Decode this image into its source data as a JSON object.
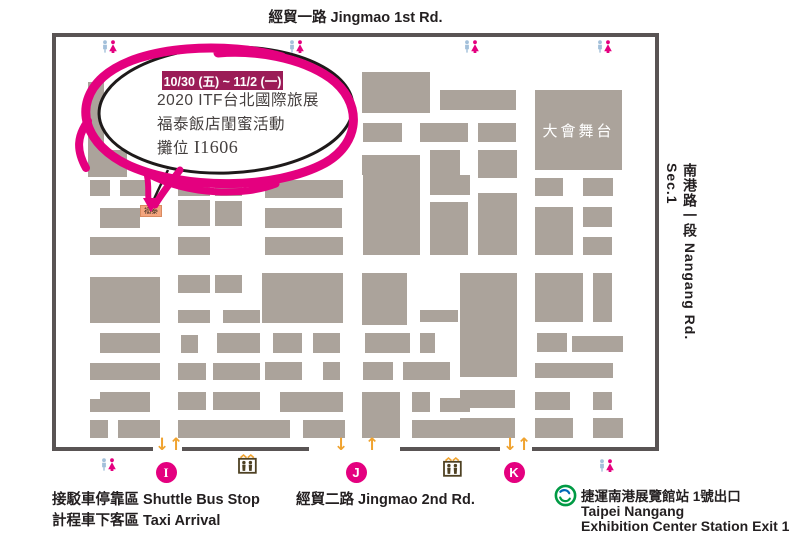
{
  "roads": {
    "top": "經貿一路 Jingmao 1st Rd.",
    "right": "南港路一段  Nangang Rd. Sec.1",
    "bottom": "經貿二路 Jingmao 2nd Rd."
  },
  "bubble": {
    "badge": "10/30 (五) ~ 11/2 (一)",
    "line1": "2020 ITF台北國際旅展",
    "line2": "福泰飯店閨蜜活動",
    "booth_prefix": "攤位 ",
    "booth_no": "I1606"
  },
  "marker": {
    "label": "福泰"
  },
  "stage": {
    "label": "大會舞台"
  },
  "legend": {
    "shuttle": "接駁車停靠區 Shuttle Bus Stop",
    "taxi": "計程車下客區 Taxi Arrival",
    "metro_station_cjk": "捷運南港展覽館站 1號出口",
    "metro_en1": "Taipei Nangang",
    "metro_en2": "Exhibition Center Station Exit 1"
  },
  "icons": {
    "down_arrow": "↓",
    "up_arrow": "↑",
    "restroom": "restroom-icon (male blue / female pink)",
    "escalator": "escalator-icon",
    "metro": "taipei-metro-logo"
  },
  "colors": {
    "booth_gray": "#ABA39B",
    "map_border": "#595454",
    "highlight_pink": "#E4007F",
    "badge_maroon": "#9B1C57",
    "arrow_orange": "#F0A32F",
    "marker_orange": "#F4A57E",
    "escalator_brown": "#4E4123",
    "restroom_male_blue": "#A3C0DA",
    "metro_green": "#009A44",
    "metro_blue": "#0068B7"
  },
  "entrances": [
    {
      "label": "I",
      "cx": 166,
      "down_x": 155,
      "up_x": 169,
      "serif": true
    },
    {
      "label": "J",
      "cx": 356,
      "down_x": 334,
      "up_x": 365,
      "serif": false
    },
    {
      "label": "K",
      "cx": 514,
      "down_x": 503,
      "up_x": 517,
      "serif": false
    }
  ],
  "map": {
    "frame": {
      "x": 52,
      "y": 33,
      "w": 607,
      "h": 418,
      "thickness": 4
    },
    "border_bottom_y": 447,
    "border_bottom_segments": [
      [
        52,
        101
      ],
      [
        182,
        127
      ],
      [
        400,
        100
      ],
      [
        532,
        127
      ]
    ],
    "restrooms": [
      [
        101,
        40
      ],
      [
        288,
        40
      ],
      [
        463,
        40
      ],
      [
        596,
        40
      ],
      [
        100,
        458
      ],
      [
        598,
        459
      ]
    ],
    "escalators": [
      [
        238,
        453
      ],
      [
        443,
        456
      ]
    ],
    "blocks": [
      [
        88,
        82,
        16,
        71
      ],
      [
        88,
        150,
        39,
        27
      ],
      [
        90,
        180,
        20,
        16
      ],
      [
        120,
        180,
        30,
        16
      ],
      [
        178,
        180,
        32,
        16
      ],
      [
        215,
        180,
        27,
        16
      ],
      [
        100,
        208,
        40,
        20
      ],
      [
        178,
        200,
        32,
        26
      ],
      [
        215,
        201,
        27,
        25
      ],
      [
        90,
        237,
        70,
        18
      ],
      [
        178,
        237,
        32,
        18
      ],
      [
        265,
        237,
        78,
        18
      ],
      [
        90,
        277,
        70,
        46
      ],
      [
        178,
        275,
        32,
        18
      ],
      [
        215,
        275,
        27,
        18
      ],
      [
        178,
        310,
        32,
        13
      ],
      [
        223,
        310,
        37,
        13
      ],
      [
        265,
        180,
        78,
        18
      ],
      [
        265,
        208,
        77,
        20
      ],
      [
        262,
        273,
        81,
        50
      ],
      [
        100,
        333,
        60,
        20
      ],
      [
        181,
        335,
        17,
        18
      ],
      [
        217,
        333,
        43,
        20
      ],
      [
        273,
        333,
        29,
        20
      ],
      [
        313,
        333,
        27,
        20
      ],
      [
        90,
        363,
        70,
        17
      ],
      [
        178,
        363,
        28,
        17
      ],
      [
        213,
        363,
        47,
        17
      ],
      [
        265,
        362,
        37,
        18
      ],
      [
        323,
        362,
        17,
        18
      ],
      [
        100,
        392,
        50,
        7
      ],
      [
        90,
        399,
        60,
        13
      ],
      [
        178,
        392,
        28,
        18
      ],
      [
        213,
        392,
        47,
        18
      ],
      [
        280,
        392,
        63,
        20
      ],
      [
        90,
        420,
        18,
        18
      ],
      [
        118,
        420,
        42,
        18
      ],
      [
        178,
        420,
        82,
        18
      ],
      [
        260,
        420,
        30,
        18
      ],
      [
        303,
        420,
        42,
        18
      ],
      [
        363,
        170,
        57,
        85
      ],
      [
        362,
        273,
        45,
        52
      ],
      [
        365,
        333,
        45,
        20
      ],
      [
        420,
        333,
        15,
        20
      ],
      [
        363,
        362,
        30,
        18
      ],
      [
        403,
        362,
        47,
        18
      ],
      [
        362,
        392,
        38,
        46
      ],
      [
        412,
        392,
        18,
        20
      ],
      [
        440,
        398,
        30,
        14
      ],
      [
        412,
        420,
        58,
        18
      ],
      [
        362,
        72,
        68,
        41
      ],
      [
        440,
        90,
        76,
        20
      ],
      [
        363,
        123,
        39,
        19
      ],
      [
        420,
        123,
        48,
        19
      ],
      [
        478,
        123,
        38,
        19
      ],
      [
        362,
        155,
        58,
        20
      ],
      [
        430,
        150,
        30,
        25
      ],
      [
        478,
        150,
        39,
        28
      ],
      [
        430,
        175,
        40,
        20
      ],
      [
        430,
        202,
        38,
        53
      ],
      [
        478,
        193,
        39,
        62
      ],
      [
        535,
        178,
        28,
        18
      ],
      [
        583,
        178,
        30,
        18
      ],
      [
        535,
        207,
        38,
        48
      ],
      [
        583,
        207,
        29,
        20
      ],
      [
        583,
        237,
        29,
        18
      ],
      [
        460,
        273,
        57,
        104
      ],
      [
        420,
        310,
        38,
        12
      ],
      [
        535,
        273,
        48,
        49
      ],
      [
        593,
        273,
        19,
        49
      ],
      [
        537,
        333,
        30,
        19
      ],
      [
        572,
        336,
        51,
        16
      ],
      [
        535,
        363,
        78,
        15
      ],
      [
        460,
        390,
        55,
        18
      ],
      [
        535,
        392,
        35,
        18
      ],
      [
        593,
        392,
        19,
        18
      ],
      [
        460,
        418,
        55,
        20
      ],
      [
        535,
        418,
        38,
        20
      ],
      [
        593,
        418,
        30,
        20
      ]
    ]
  }
}
